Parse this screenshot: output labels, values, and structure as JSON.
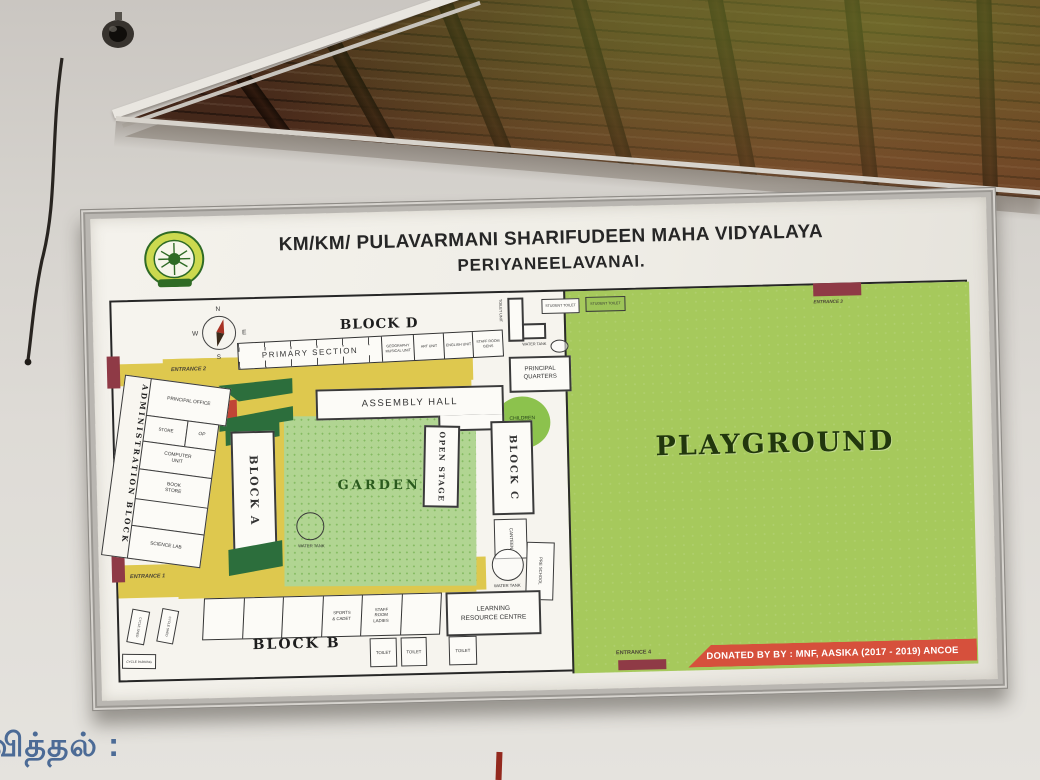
{
  "board": {
    "title_line1": "KM/KM/ PULAVARMANI SHARIFUDEEN MAHA VIDYALAYA",
    "title_line2": "PERIYANEELAVANAI.",
    "donated_text": "DONATED BY BY : MNF, AASIKA (2017 - 2019) ANCOE"
  },
  "compass": {
    "n": "N",
    "e": "E",
    "s": "S",
    "w": "W"
  },
  "blocks": {
    "block_a": "BLOCK A",
    "block_b": "BLOCK B",
    "block_c": "BLOCK C",
    "block_d": "BLOCK D"
  },
  "areas": {
    "playground": "PLAYGROUND",
    "garden": "GARDEN",
    "children_park": "CHILDREN PARK"
  },
  "rooms": {
    "primary_section": "PRIMARY SECTION",
    "geo_unit": "GEOGRAPHY MUSICAL UNIT",
    "art_unit": "ART UNIT",
    "english_unit": "ENGLISH UNIT",
    "staff_room_gents": "STAFF ROOM GENS",
    "toilet_unit": "TOILET UNIT",
    "student_toilet_1": "STUDENT TOILET",
    "student_toilet_2": "STUDENT TOILET",
    "water_tank_1": "WATER TANK",
    "water_tank_2": "WATER TANK",
    "water_tank_3": "WATER TANK",
    "principal_quarters": "PRINCIPAL QUARTERS",
    "admin_block": "ADMINISTRATION BLOCK",
    "principal_office": "PRINCIPAL OFFICE",
    "store": "STORE",
    "op": "OP",
    "computer_unit": "COMPUTER UNIT",
    "book_store": "BOOK STORE",
    "science_lab": "SCIENCE LAB",
    "assembly_hall": "ASSEMBLY HALL",
    "open_stage": "OPEN STAGE",
    "canteen": "CANTEEN",
    "pre_school": "PRE SCHOOL",
    "learning_resource_centre": "LEARNING RESOURCE CENTRE",
    "sports_cadet": "SPORTS & CADET",
    "staff_room_ladies": "STAFF ROOM LADIES",
    "toilet_1": "TOILET",
    "toilet_2": "TOILET",
    "toilet_3": "TOILET",
    "shed_1": "CYCLE SHED",
    "shed_2": "CYCLE SHED",
    "shed_3": "CYCLE PARKING"
  },
  "entrances": {
    "e1": "ENTRANCE 1",
    "e2": "ENTRANCE 2",
    "e3": "ENTRANCE 3",
    "e4": "ENTRANCE 4"
  },
  "wall": {
    "tamil_text": "வித்தல் :"
  }
}
